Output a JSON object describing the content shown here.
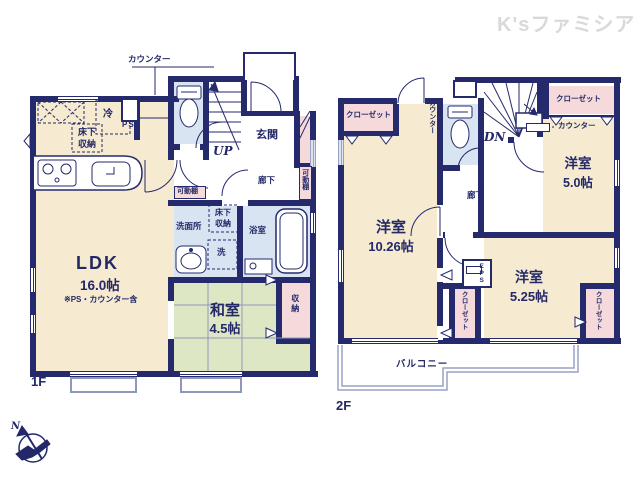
{
  "watermark": "K'sファミシア",
  "f1": {
    "floor": "1F",
    "ldk": "LDK",
    "ldk_size": "16.0帖",
    "ldk_note": "※PS・カウンター含",
    "washitsu": "和室",
    "washitsu_size": "4.5帖",
    "genkan": "玄関",
    "rouka": "廊下",
    "senmenjo": "洗面所",
    "yokushitsu": "浴室",
    "shuno": "収納",
    "kadodana": "可動棚",
    "yukashita": "床下収納",
    "counter": "カウンター",
    "rei": "冷",
    "ps": "PS",
    "sen": "洗",
    "up": "UP"
  },
  "f2": {
    "floor": "2F",
    "yoshitsu": "洋室",
    "y1_size": "10.26帖",
    "y2_size": "5.0帖",
    "y3_size": "5.25帖",
    "closet": "クローゼット",
    "counter": "カウンター",
    "rouka": "廊下",
    "eps": "EPS",
    "dn": "DN",
    "balcony": "バルコニー"
  },
  "compass": {
    "north": "N"
  },
  "colors": {
    "wall": "#252a6d",
    "room": "#f6ead0",
    "tatami": "#dee7c4",
    "closet": "#f6d9da",
    "wet": "#d9e4f2",
    "text": "#232968"
  }
}
